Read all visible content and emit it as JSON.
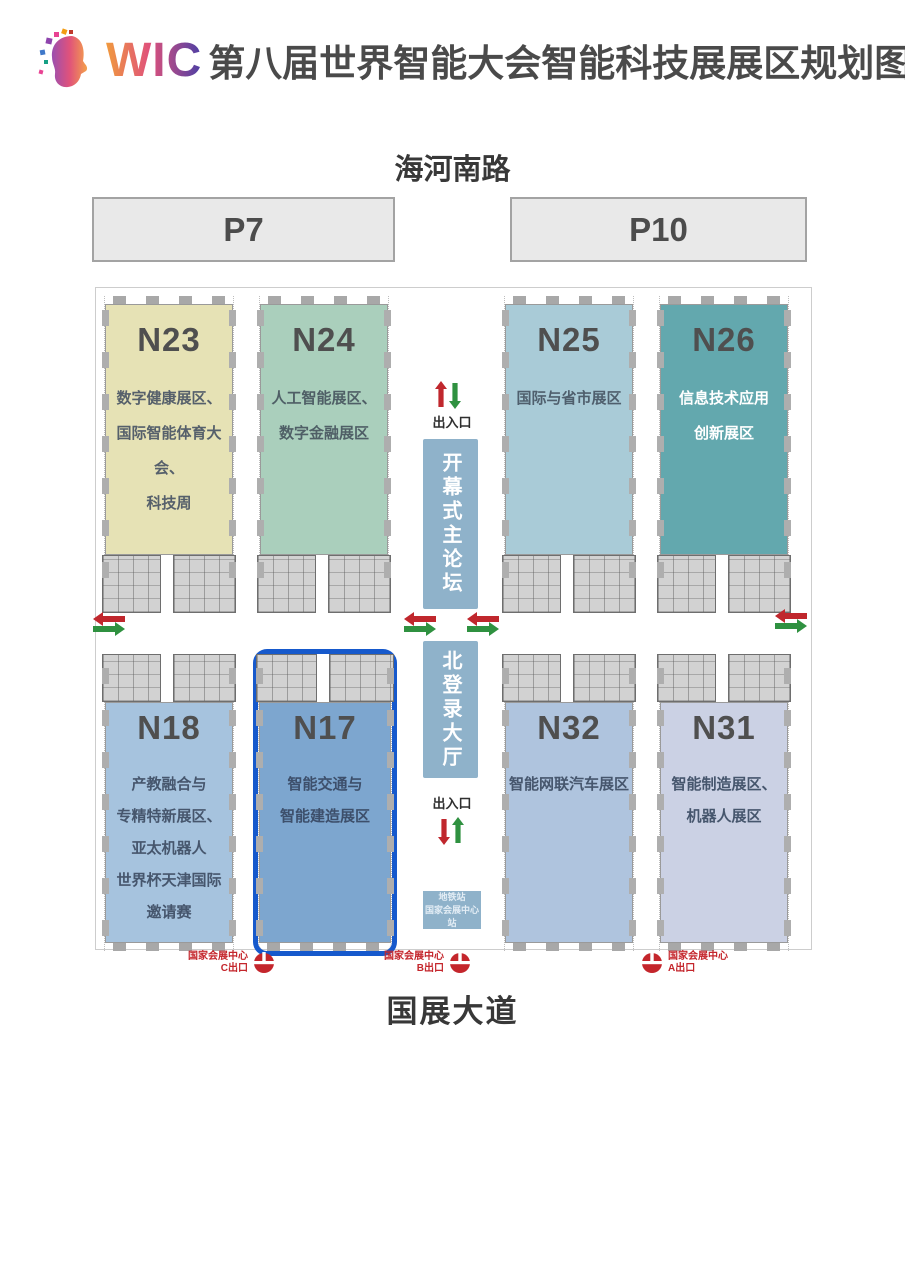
{
  "title": {
    "logo": "WIC",
    "text": "第八届世界智能大会智能科技展展区规划图"
  },
  "roads": {
    "top": "海河南路",
    "bottom": "国展大道"
  },
  "parking": {
    "p7": "P7",
    "p10": "P10"
  },
  "halls": [
    {
      "id": "N23",
      "lines": [
        "数字健康展区、",
        "国际智能体育大会、",
        "科技周"
      ],
      "color": "#e6e2b5",
      "text_color": "#56606b"
    },
    {
      "id": "N24",
      "lines": [
        "人工智能展区、",
        "数字金融展区"
      ],
      "color": "#aacfbc",
      "text_color": "#4f5f66"
    },
    {
      "id": "N25",
      "lines": [
        "国际与省市展区"
      ],
      "color": "#a9cbd7",
      "text_color": "#4f5f6d"
    },
    {
      "id": "N26",
      "lines": [
        "信息技术应用",
        "创新展区"
      ],
      "color": "#63a8ae",
      "text_color": "#ffffff"
    },
    {
      "id": "N18",
      "lines": [
        "产教融合与",
        "专精特新展区、",
        "亚太机器人",
        "世界杯天津国际",
        "邀请赛"
      ],
      "color": "#a6c3de",
      "text_color": "#46566d"
    },
    {
      "id": "N17",
      "lines": [
        "智能交通与",
        "智能建造展区"
      ],
      "color": "#7da6cf",
      "text_color": "#3d4f6b",
      "highlighted": true
    },
    {
      "id": "N32",
      "lines": [
        "智能网联汽车展区"
      ],
      "color": "#afc4de",
      "text_color": "#46566d"
    },
    {
      "id": "N31",
      "lines": [
        "智能制造展区、",
        "机器人展区"
      ],
      "color": "#cbd1e4",
      "text_color": "#46566d"
    }
  ],
  "corridor": {
    "forum": "开幕式主论坛",
    "north_hall": "北登录大厅",
    "entrance_top": "出入口",
    "entrance_bottom": "出入口",
    "metro": {
      "line1": "地铁站",
      "line2": "国家会展中心站"
    }
  },
  "exits": [
    {
      "center": "国家会展中心",
      "exit": "C出口"
    },
    {
      "center": "国家会展中心",
      "exit": "B出口"
    },
    {
      "center": "国家会展中心",
      "exit": "A出口"
    }
  ],
  "colors": {
    "arrow_red": "#c0272d",
    "arrow_green": "#2f9140",
    "highlight_blue": "#1659cc",
    "corridor_box": "#8fb2ca",
    "exit_red": "#c4262c",
    "hall_number": "#4f4f4f",
    "title_text": "#4a4a4a"
  }
}
